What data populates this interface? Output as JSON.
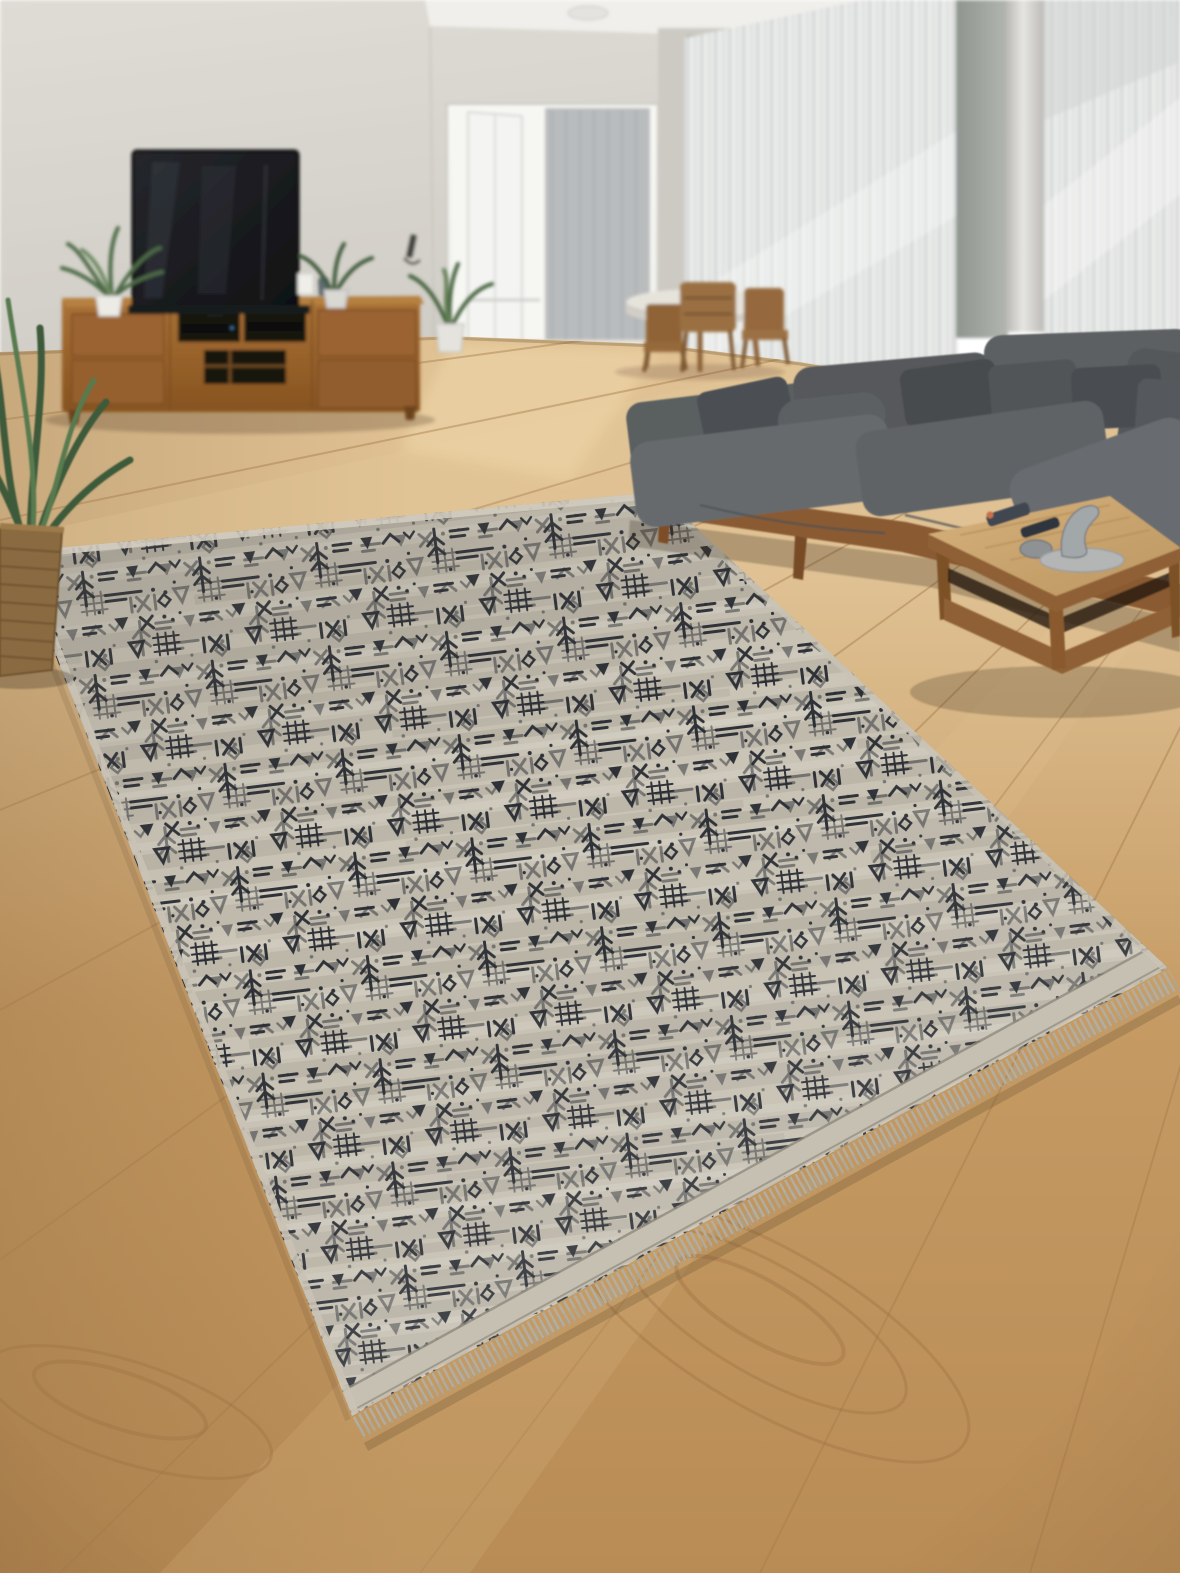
{
  "scene": {
    "type": "interior-photograph",
    "room": "living-room",
    "objects": [
      {
        "name": "area-rug",
        "description": "gray-beige area rug with black tribal glyph pattern, bound edges and fringe, shown in perspective on the floor"
      },
      {
        "name": "sectional-sofa",
        "description": "gray L-shaped fabric sectional with loose back pillows on a wooden plinth base"
      },
      {
        "name": "coffee-table",
        "description": "low square wooden coffee table with lower shelf; remotes, a stone and a gray sculpture on top"
      },
      {
        "name": "tv",
        "description": "dark flat-screen television above a wooden media console"
      },
      {
        "name": "media-console",
        "description": "long wooden TV stand with drawers, open shelves and black AV equipment"
      },
      {
        "name": "potted-plants",
        "description": "green houseplants in white pots on the console and a floor plant in a woven basket at left"
      },
      {
        "name": "dining-set",
        "description": "round wooden dining table with wooden chairs in front of sheer curtains"
      },
      {
        "name": "balcony-door",
        "description": "open white-framed glass doorway with bright daylight and a gray inner curtain"
      },
      {
        "name": "sheer-curtains",
        "description": "floor-to-ceiling white sheer curtains along the back and right walls with a sunlit band"
      },
      {
        "name": "wood-floor",
        "description": "light oak plank flooring with diagonal seams and cathedral grain"
      }
    ]
  },
  "palette": {
    "ceiling": "#f0efeb",
    "wall_top": "#dfdcd5",
    "wall_bottom": "#d0cdc6",
    "wall_side": "#cdcac3",
    "door_light": "#f6f6f3",
    "door_curtain": "#b9bcbd",
    "curtain": "#e7e8e6",
    "curtain_stripe": "#d6dad9",
    "pillar": "#9ba09b",
    "column": "#e0dfdb",
    "floor_back": "#dfc193",
    "floor_mid": "#c59a63",
    "floor_front": "#b98c55",
    "floor_seam": "#a67c4b",
    "console_wood": "#9b6331",
    "console_dark": "#7b4c21",
    "tv_screen": "#17191c",
    "sofa": "#5d6163",
    "sofa_dark": "#4b4f52",
    "sofa_light": "#676c6f",
    "sofa_base_wood": "#8a5a33",
    "table_top": "#cfab74",
    "table_frame": "#8f6134",
    "rug_base": "#cbc5b7",
    "rug_symbol": "#262a31",
    "rug_binding": "#c6c0b2",
    "rug_fringe": "#b3ae9f",
    "plant_green": "#46633f",
    "basket": "#8a6a3f",
    "chair_wood": "#9a6f42"
  }
}
